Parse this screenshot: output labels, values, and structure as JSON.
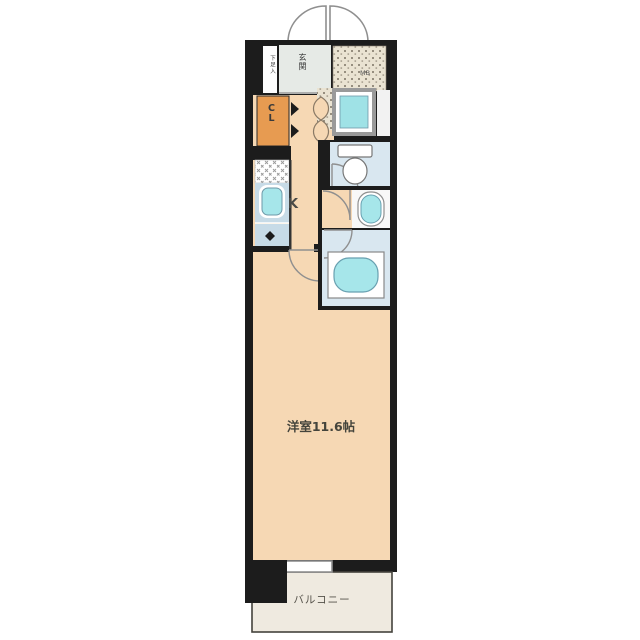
{
  "plan": {
    "type": "apartment-floor-plan",
    "labels": {
      "entrance": "玄関",
      "shoe_cabinet": "下足入",
      "meter_box": "MB",
      "closet": "CL",
      "kitchen": "K",
      "main_room": "洋室11.6帖",
      "balcony": "バルコニー"
    },
    "colors": {
      "wall": "#1c1c1c",
      "room_floor": "#f6d8b4",
      "closet": "#e79b51",
      "wet_area_floor": "#d9e7f0",
      "fixture_water": "#a6e6ea",
      "kitchen_counter": "#c7dbe7",
      "balcony": "#efeae0",
      "meter_box_bg": "#eae3d2",
      "entrance_floor": "#e6eae6",
      "door_arc": "#8f8f8f",
      "background": "#ffffff"
    }
  }
}
